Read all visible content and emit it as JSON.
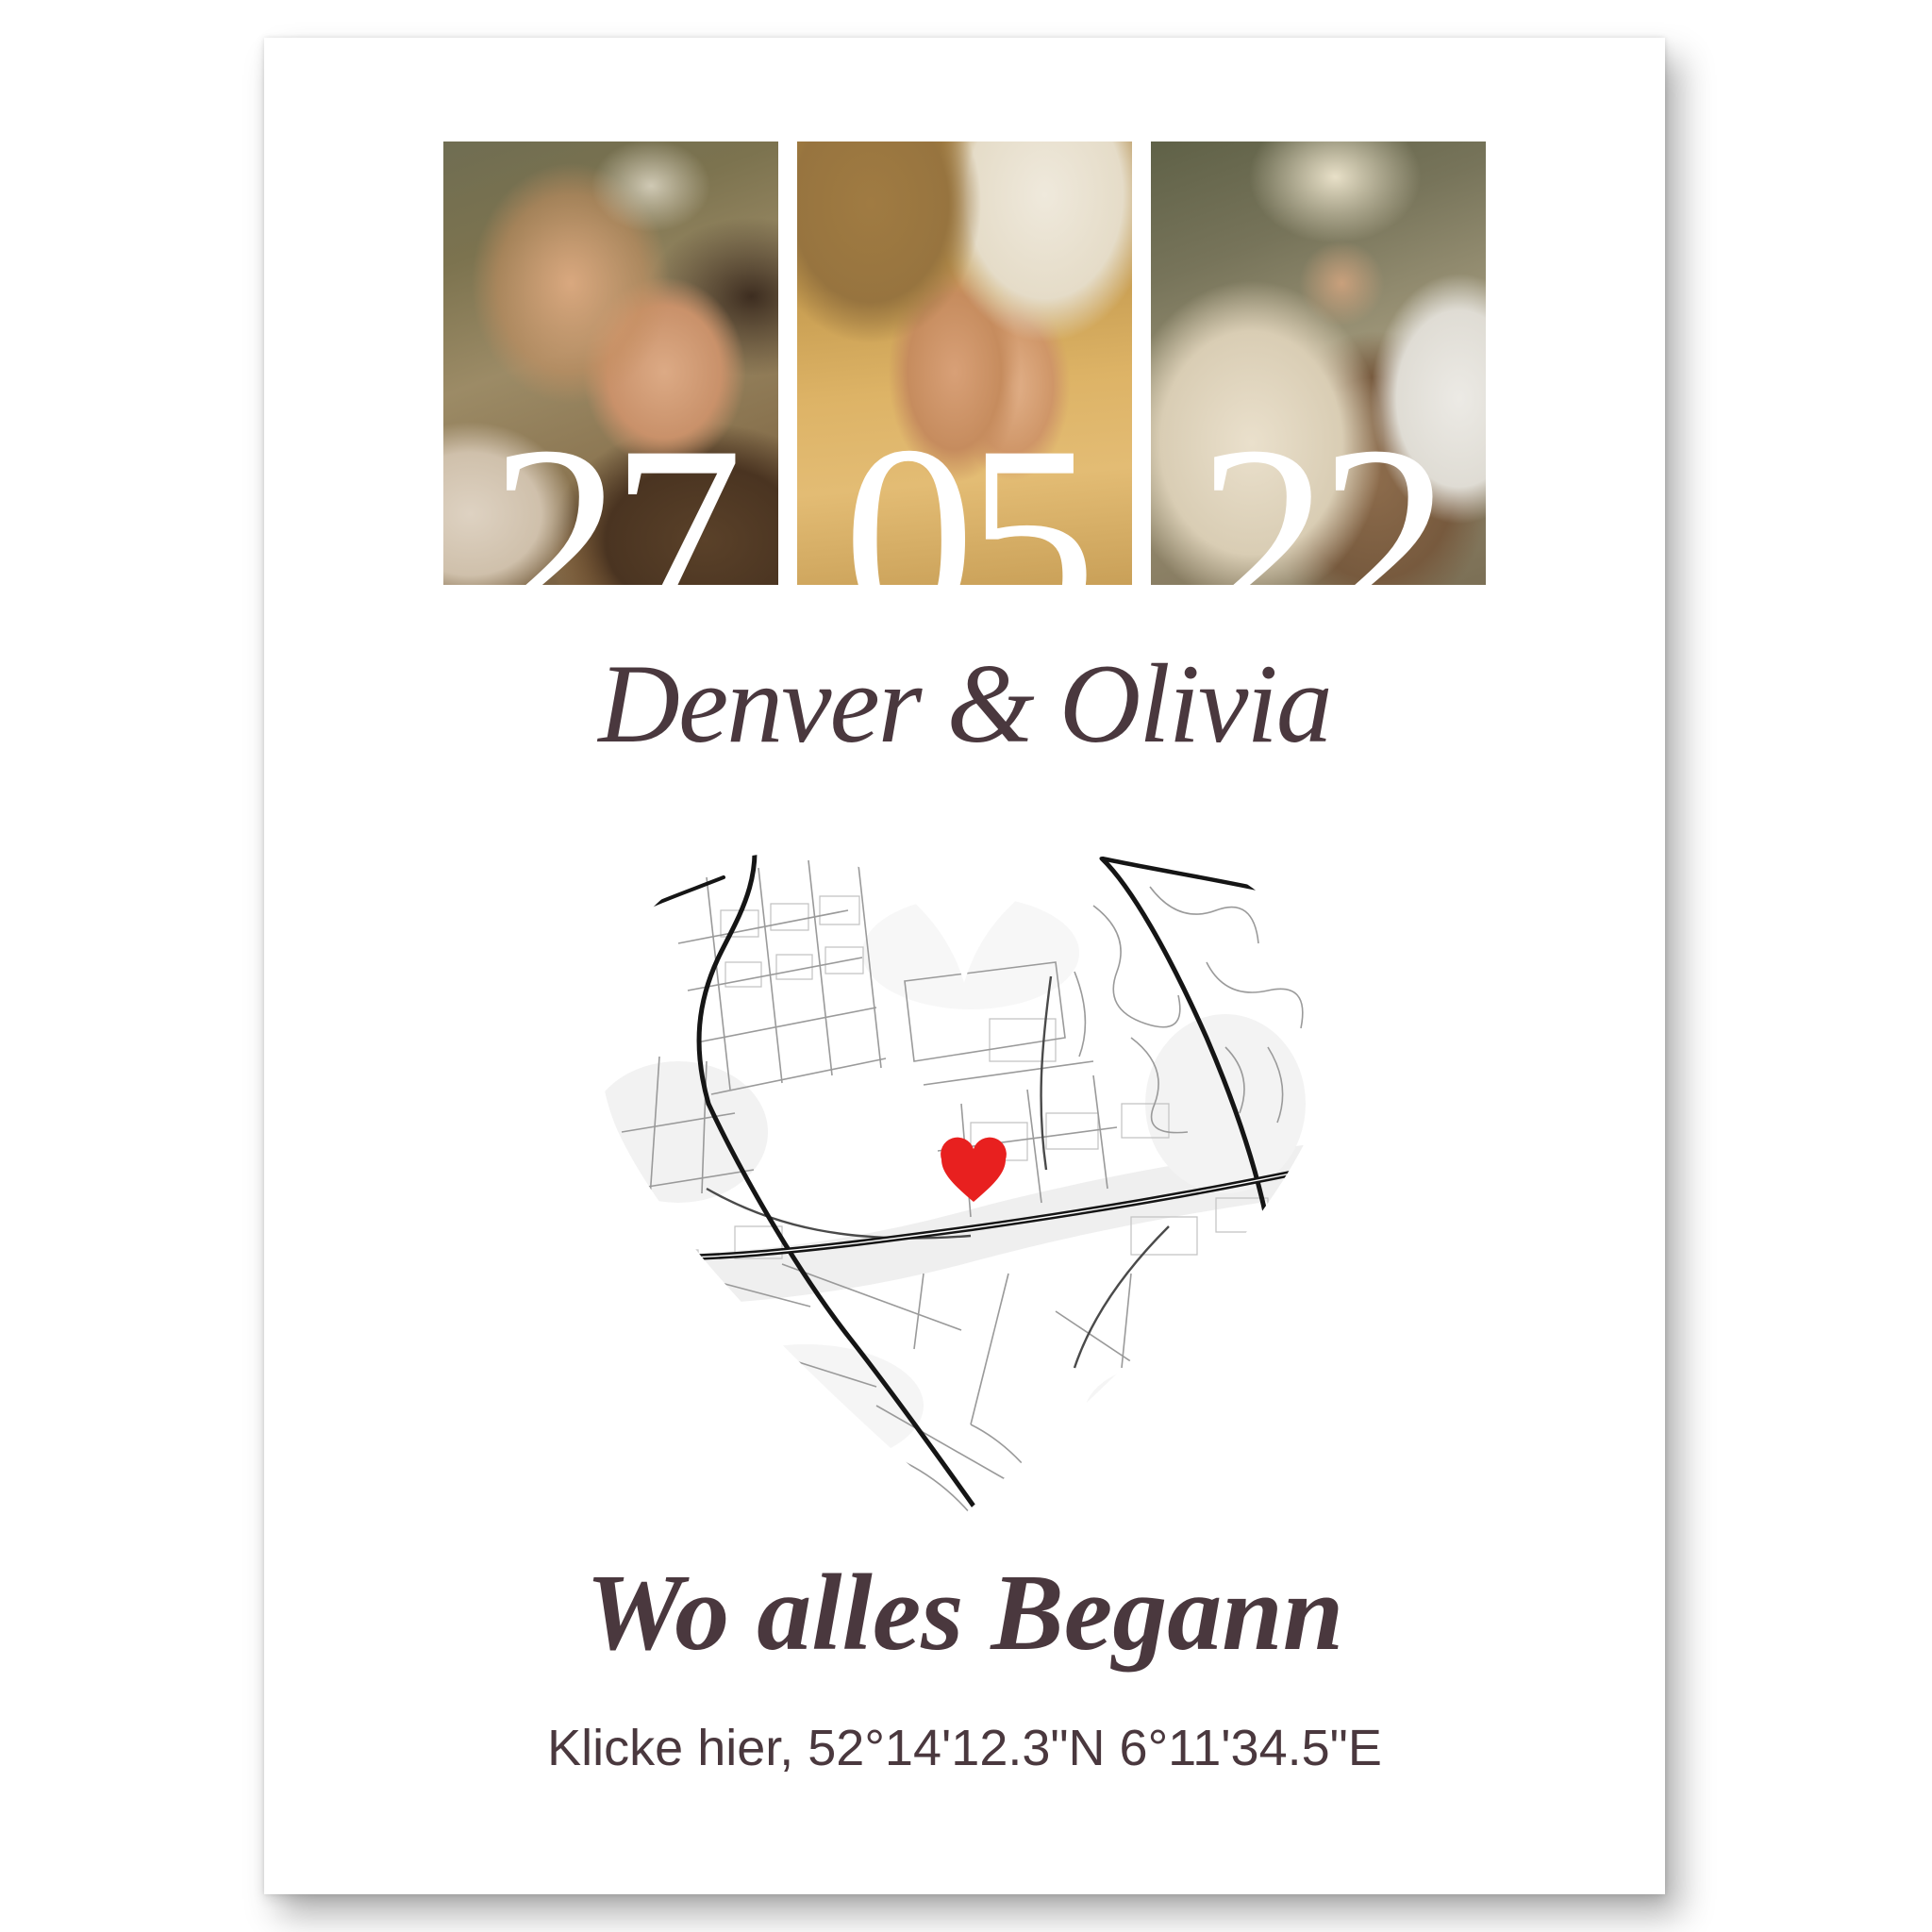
{
  "poster": {
    "photos": [
      {
        "name": "couple-nose-to-nose-photo",
        "number": "27"
      },
      {
        "name": "pinky-promise-hands-photo",
        "number": "05"
      },
      {
        "name": "couple-embracing-by-fence-photo",
        "number": "22"
      }
    ],
    "names_line": "Denver & Olivia",
    "title": "Wo alles Begann",
    "coordinates_line": "Klicke hier, 52°14'12.3\"N 6°11'34.5\"E",
    "map": {
      "shape": "heart",
      "marker": "heart-marker-icon",
      "marker_color": "#e8201f",
      "road_color_major": "#151515",
      "road_color_minor": "#9a9a9a"
    },
    "colors": {
      "text": "#4a383e",
      "date_numbers": "#ffffff",
      "paper": "#ffffff"
    }
  }
}
